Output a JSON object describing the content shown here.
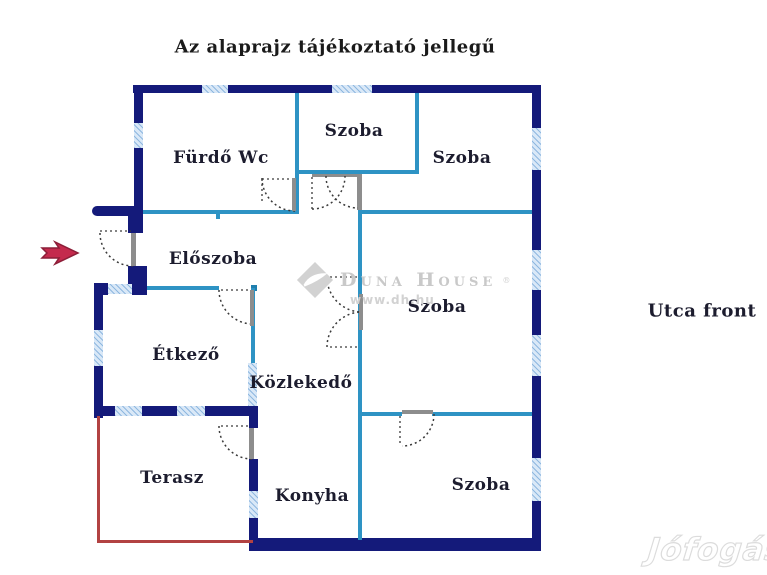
{
  "title": "Az alaprajz tájékoztató jellegű",
  "street_label": "Utca front",
  "rooms": {
    "furdo": "Fürdő Wc",
    "szoba_top_mid": "Szoba",
    "szoba_top_right": "Szoba",
    "eloszoba": "Előszoba",
    "szoba_mid_right": "Szoba",
    "etkezo": "Étkező",
    "kozlekedo": "Közlekedő",
    "terasz": "Terasz",
    "konyha": "Konyha",
    "szoba_bottom_right": "Szoba"
  },
  "watermark": {
    "brand": "Duna House",
    "reg": "®",
    "url": "www.dh.hu",
    "portal": "Jófogás"
  },
  "colors": {
    "outer_wall": "#141a7a",
    "partition_wall": "#2e93c4",
    "window_fill": "#d9e8f7",
    "terrace_line": "#b24242",
    "entrance_arrow": "#c42a4d"
  }
}
